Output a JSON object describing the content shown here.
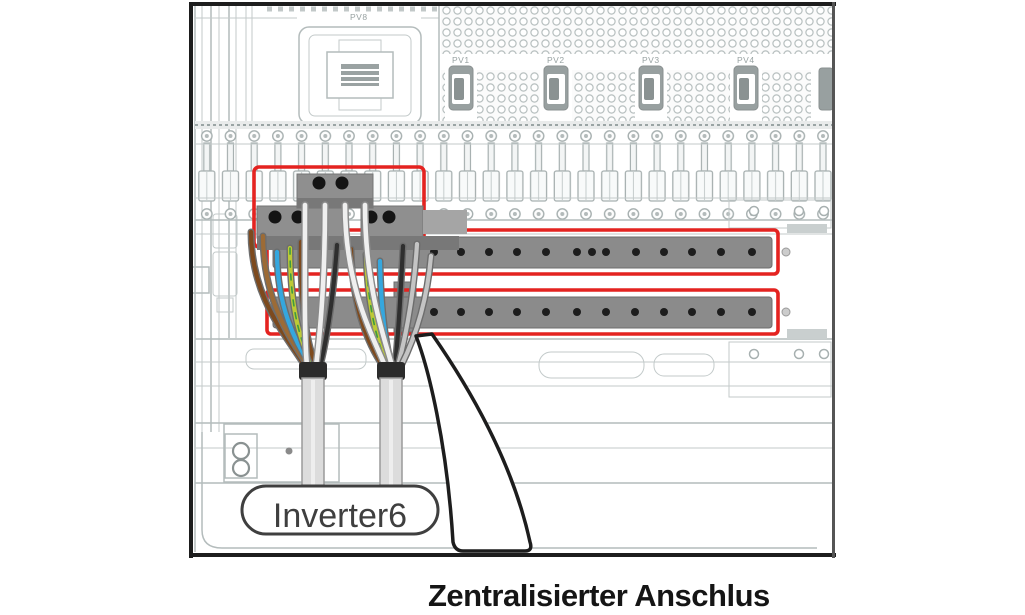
{
  "diagram": {
    "caption": "Zentralisierter Anschlus",
    "inverter_label": "Inverter6",
    "labels": {
      "pv8": "PV8",
      "pv1": "PV1",
      "pv2": "PV2",
      "pv3": "PV3",
      "pv4": "PV4"
    },
    "busbar_screws": {
      "top_row_count": 13,
      "bottom_row_count": 12
    },
    "colors": {
      "highlight_red": "#e42320",
      "busbar_gray": "#8b8b8b",
      "terminal_gray": "#8f8f8f",
      "terminal_dark": "#787878",
      "wire_brown": "#7d4a1e",
      "wire_brown_light": "#9c6b36",
      "wire_blue": "#35a7de",
      "wire_yellow_green": "#bdca36",
      "wire_green_stripe": "#3f9b3f",
      "wire_black": "#2f2f2f",
      "wire_gray": "#c4c4c4",
      "cable_sheath": "#dcdcdc",
      "line_art": "#b4bcbc",
      "border": "#1d1d1d"
    }
  }
}
